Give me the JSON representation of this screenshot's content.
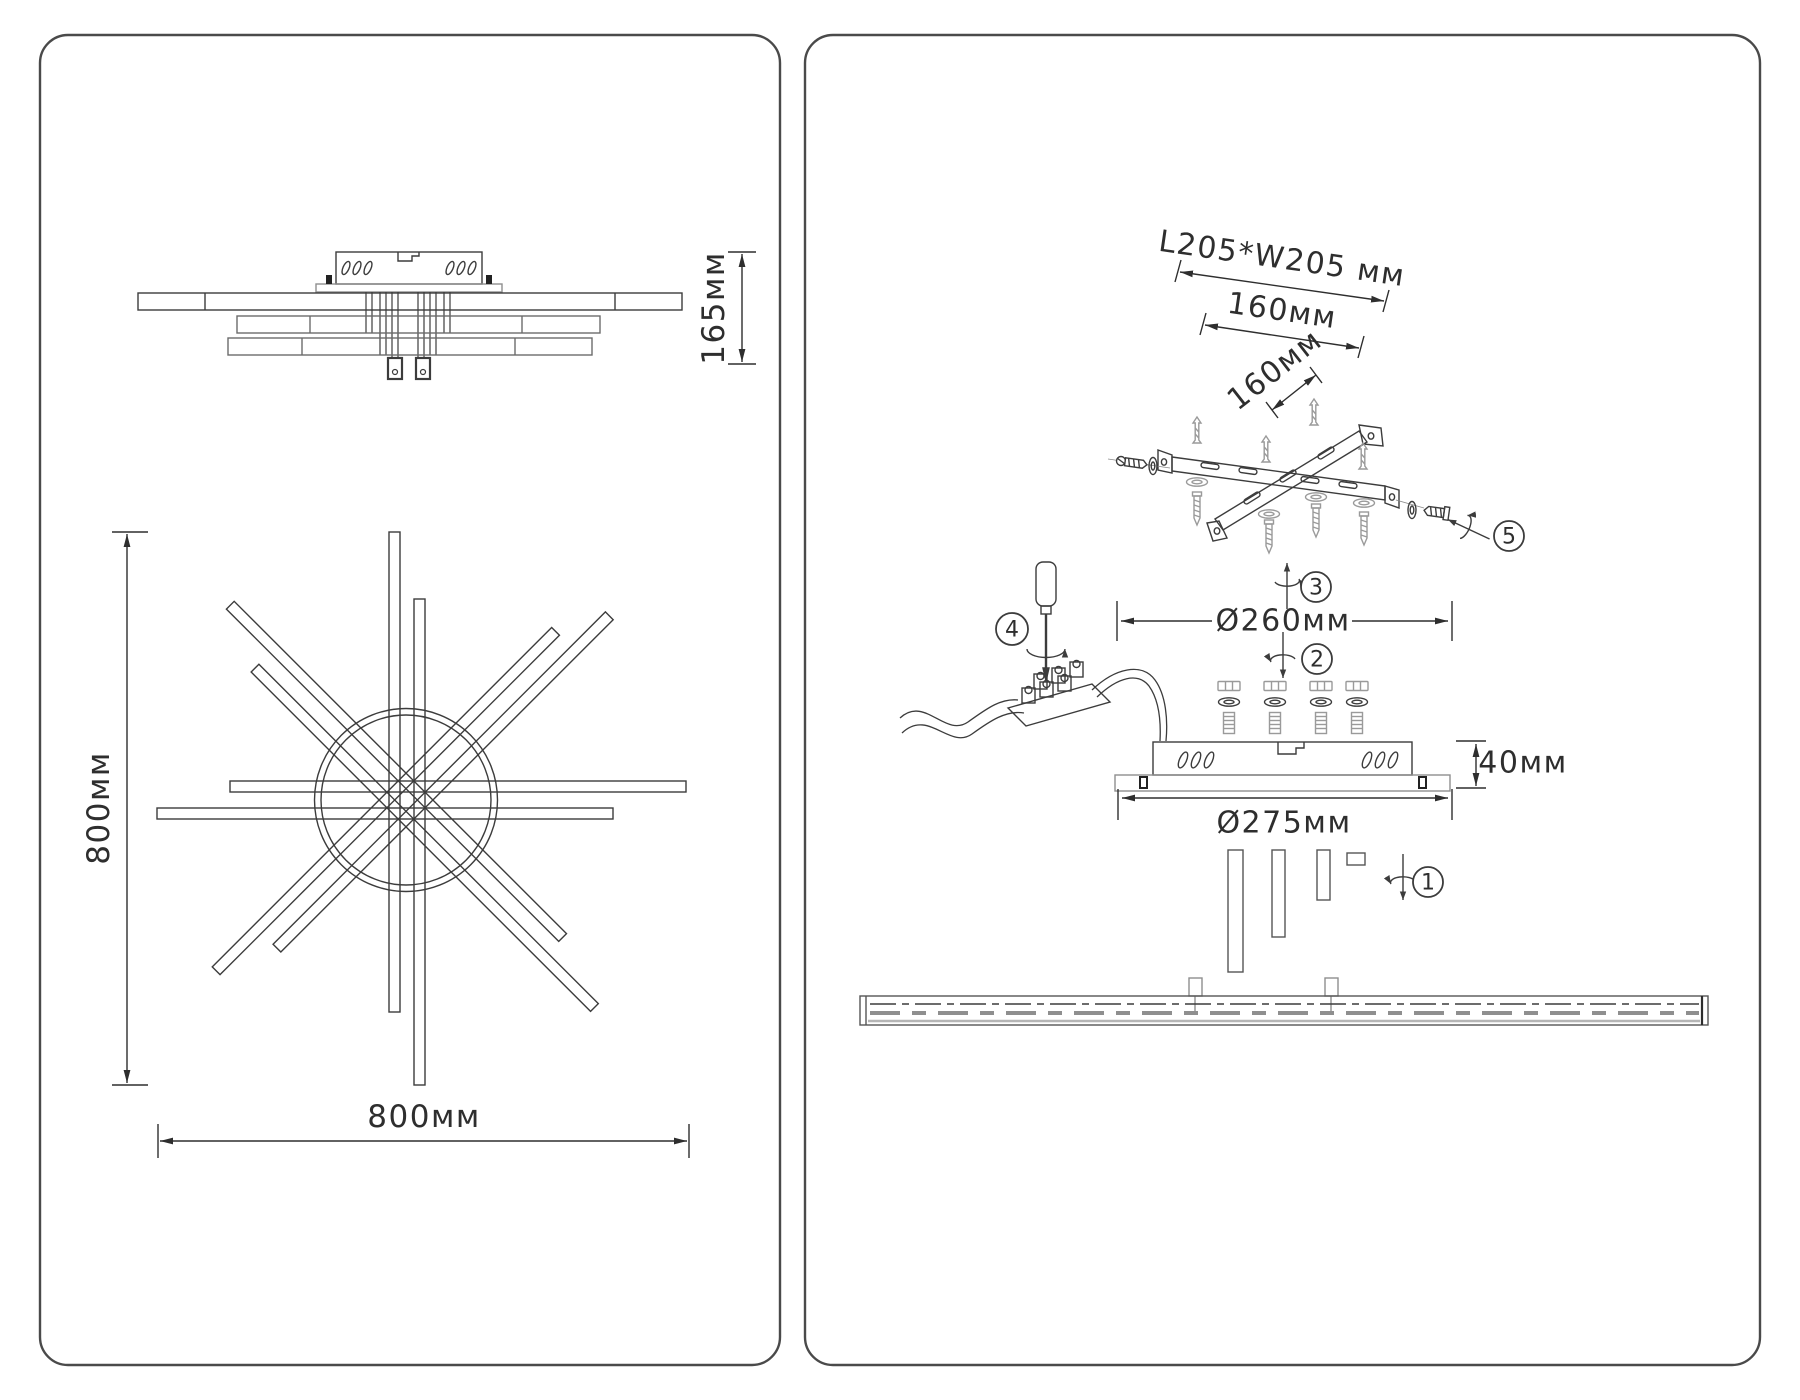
{
  "left_panel": {
    "side_view": {
      "height_dim": "165мм"
    },
    "top_view": {
      "width_dim": "800мм",
      "height_dim": "800мм"
    }
  },
  "right_panel": {
    "bracket": {
      "overall_dim": "L205*W205 мм",
      "spacing_dim_long": "160мм",
      "spacing_dim_short": "160мм"
    },
    "canopy": {
      "bracket_circle_dim": "Ø260мм",
      "base_dim": "Ø275мм",
      "height_dim": "40мм"
    },
    "steps": [
      {
        "num": "1"
      },
      {
        "num": "2"
      },
      {
        "num": "3"
      },
      {
        "num": "4"
      },
      {
        "num": "5"
      }
    ]
  },
  "colors": {
    "ink": "#2e2e2e",
    "drawing": "#3c3c3c",
    "gray": "#9a9a9a",
    "background": "#ffffff",
    "panel_border": "#4a4a4a"
  }
}
